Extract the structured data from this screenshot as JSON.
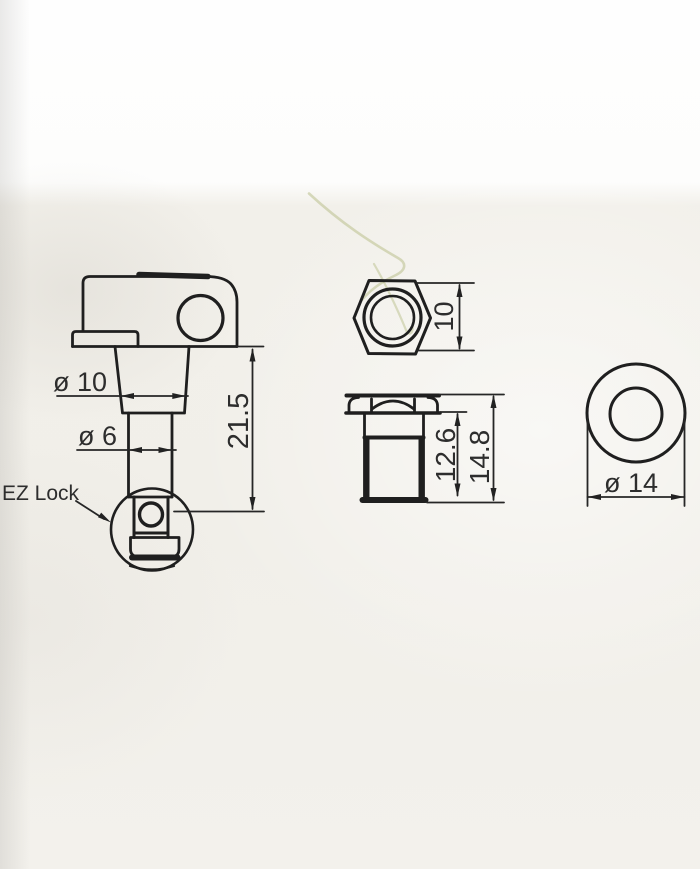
{
  "drawing": {
    "tuner": {
      "upper_post_diameter": "ø 10",
      "lower_post_diameter": "ø 6",
      "post_length": "21.5",
      "lock_label": "EZ Lock"
    },
    "hex_nut": {
      "across_flats": "10"
    },
    "bushing": {
      "sleeve_length": "12.6",
      "overall_length": "14.8"
    },
    "washer": {
      "outer_diameter": "ø 14"
    }
  },
  "colors": {
    "line": "#1f1f1f",
    "dimension_text": "#2d2d2d",
    "paper": "#f1efe9",
    "background_top": "#fefefe",
    "fiber_artifact": "#b9c08c"
  }
}
